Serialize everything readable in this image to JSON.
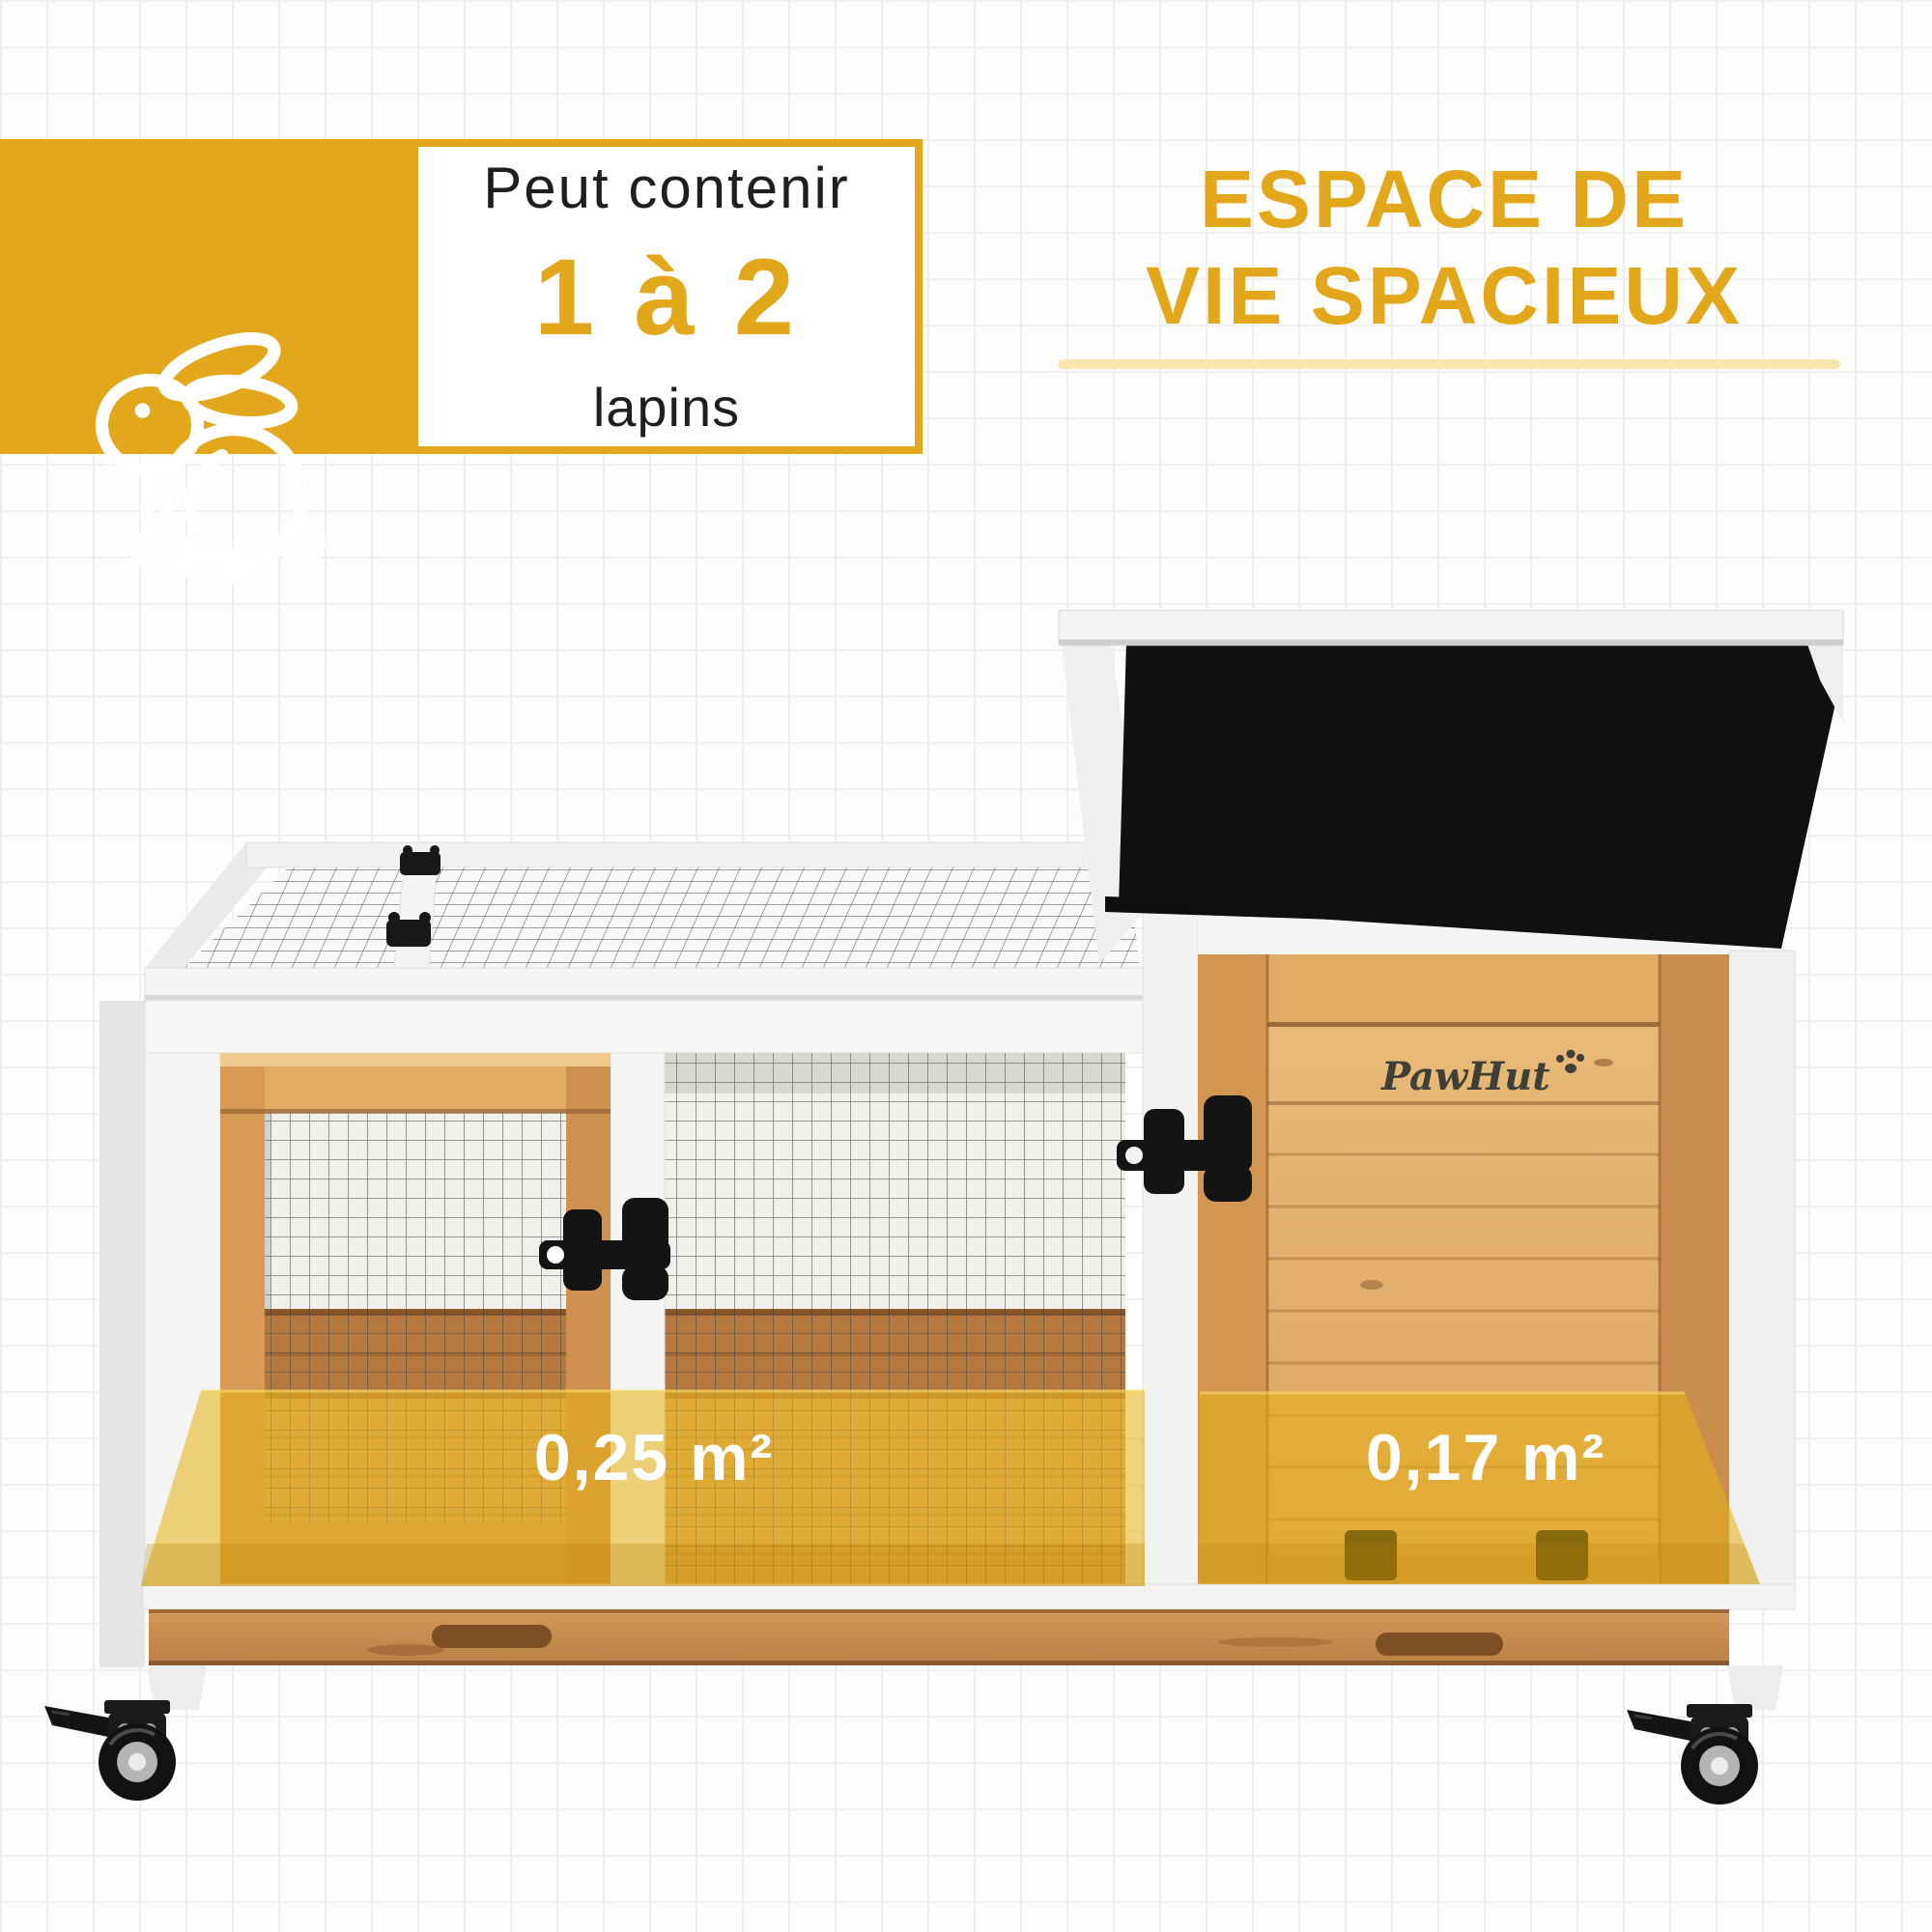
{
  "page": {
    "background_color": "#fdfdfc",
    "grid_line_color": "#f1f0ee",
    "grid_size_px": 48
  },
  "badge": {
    "prefix": "Peut contenir",
    "value": "1 à 2",
    "unit": "lapins",
    "accent_color": "#E2A71B",
    "panel_bg": "#ffffff",
    "icon": "rabbit-icon"
  },
  "title": {
    "line1": "ESPACE DE",
    "line2": "VIE SPACIEUX",
    "color": "#E3A71B",
    "underline_color": "#F8E6AE"
  },
  "areas": {
    "left": "0,25 m²",
    "right": "0,17 m²",
    "label_color": "#ffffff",
    "overlay_color": "#E6B012"
  },
  "brand": {
    "logo_text": "PawHut",
    "logo_color": "#3F3F38",
    "icon": "paw-print-icon"
  },
  "hutch": {
    "roof_color": "#101010",
    "frame_color": "#F4F4F2",
    "wood_color": "#DFA560",
    "wood_dark": "#8A5A2E",
    "baseboard_color": "#B5793F",
    "drawer_color": "#CE9A58",
    "mesh_color": "#45453F",
    "hardware_color": "#161616"
  },
  "icons": {
    "rabbit-icon": "white outline sitting rabbit",
    "paw-print-icon": "four-dot paw print",
    "lid-hinge-icon": "black lid hinge",
    "door-latch-icon": "black swivel latch",
    "caster-wheel-icon": "locking caster wheel"
  }
}
